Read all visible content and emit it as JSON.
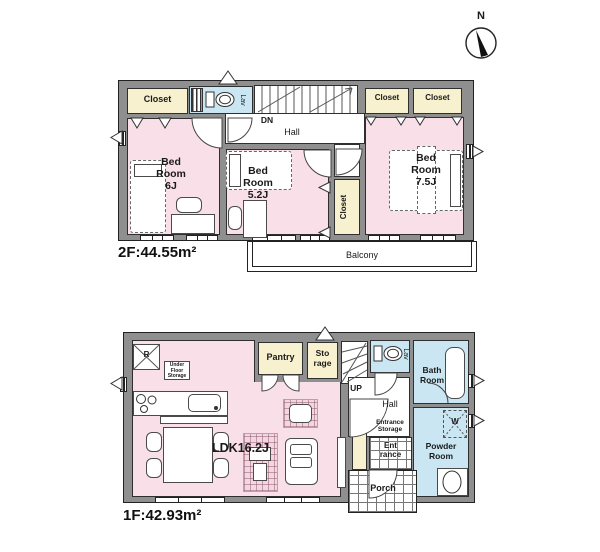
{
  "compass": {
    "north_label": "N"
  },
  "colors": {
    "room_pink": "#f8dfe8",
    "closet_cream": "#f7f1cf",
    "wet_area_blue": "#c9e6f2",
    "wall_gray": "#8f8f8f"
  },
  "floor2": {
    "area_label": "2F:44.55m²",
    "closet_top_left": "Closet",
    "lav": "Lav",
    "stairs_dn": "DN",
    "hall": "Hall",
    "bedroom6": [
      "Bed",
      "Room",
      "6J"
    ],
    "bedroom52": [
      "Bed",
      "Room",
      "5.2J"
    ],
    "bedroom75": [
      "Bed",
      "Room",
      "7.5J"
    ],
    "closet_top_right_1": "Closet",
    "closet_top_right_2": "Closet",
    "closet_mid": "Closet",
    "balcony": "Balcony"
  },
  "floor1": {
    "area_label": "1F:42.93m²",
    "refrigerator": "R",
    "under_floor_storage": [
      "Under",
      "Floor",
      "Storage"
    ],
    "pantry": "Pantry",
    "storage": [
      "Sto",
      "rage"
    ],
    "stairs_up": "UP",
    "lav": "Lav",
    "bath_room": [
      "Bath",
      "Room"
    ],
    "hall": "Hall",
    "entrance_storage": [
      "Entrance",
      "Storage"
    ],
    "entrance": [
      "Ent",
      "rance"
    ],
    "porch": "Porch",
    "powder_room": [
      "Powder",
      "Room"
    ],
    "washer": "W",
    "ldk": "LDK16.2J"
  }
}
